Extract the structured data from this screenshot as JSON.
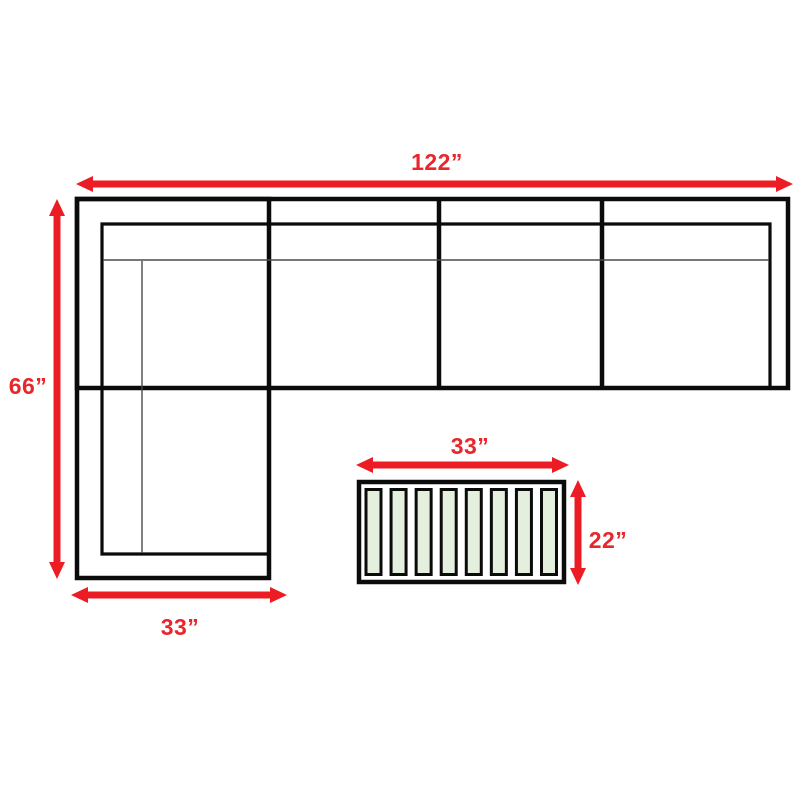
{
  "sofa": {
    "overall_width_label": "122”",
    "overall_depth_label": "66”",
    "chaise_width_label": "33”",
    "seat_sections": 4
  },
  "coffee_table": {
    "width_label": "33”",
    "depth_label": "22”",
    "slat_count": 8
  },
  "colors": {
    "dimension_arrow_red": "#ec1c24",
    "dimension_text_red": "#e8262c",
    "outline_black": "#0b0b0b",
    "slat_fill_green": "#e5efde",
    "background": "#ffffff"
  }
}
